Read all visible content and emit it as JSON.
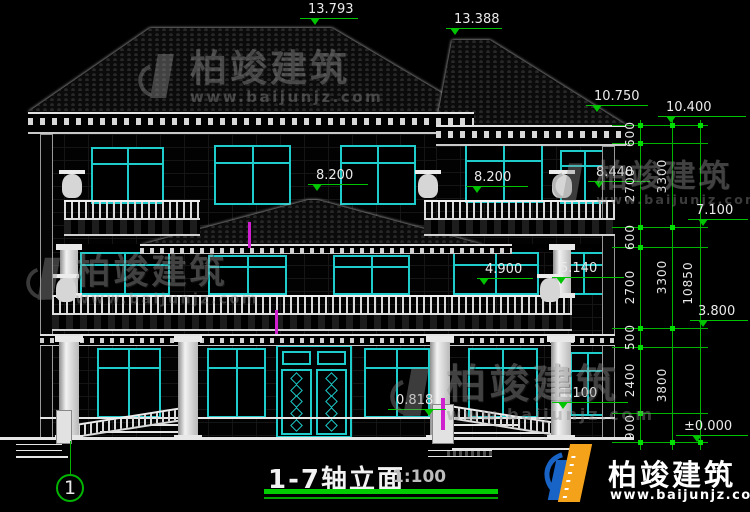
{
  "drawing": {
    "title": "1-7轴立面",
    "scale": "1:100",
    "axis_label": "1"
  },
  "elevations": {
    "ridge_left": "13.793",
    "ridge_right": "13.388",
    "eave_left": "10.750",
    "eave_right": "10.400",
    "parapet_right": "8.440",
    "porch_ridge": "8.200",
    "rail_third": "8.200",
    "level_7100": "7.100",
    "rail_second_top": "5.140",
    "rail_second": "4.900",
    "level_3800": "3.800",
    "terrace": "1.100",
    "entry_step": "0.818",
    "ground": "±0.000"
  },
  "dimensions": {
    "detail_chain": [
      "600",
      "2700",
      "600",
      "2700",
      "500",
      "2400",
      "900"
    ],
    "floor_chain": [
      "3300",
      "3300",
      "3800"
    ],
    "total_chain": [
      "10850"
    ]
  },
  "watermark": {
    "brand": "柏竣建筑",
    "url": "www.baijunjz.com"
  },
  "logo": {
    "brand": "柏竣建筑",
    "url": "www.baijunjz.com"
  },
  "colors": {
    "window_cyan": "#1ecccc",
    "dim_green": "#00c400",
    "line_white": "#e6e6e6",
    "marker_magenta": "#cf1fcf",
    "logo_blue": "#1863c6",
    "logo_orange": "#f5a21b",
    "watermark_gray": "#9b9b9b"
  }
}
